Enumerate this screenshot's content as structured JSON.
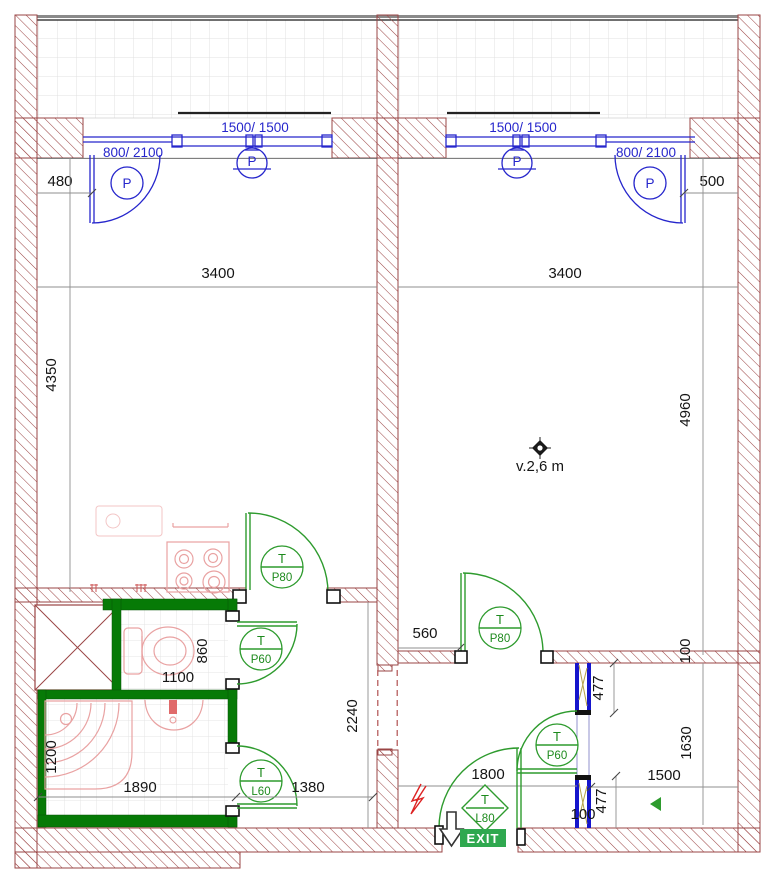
{
  "colors": {
    "wall_hatch": "#9a4444",
    "window_blue": "#2626cc",
    "door_green": "#2e9b2e",
    "bath_wall_green": "#067a06",
    "fixture_pink": "#e9a2a2",
    "exit_bg": "#2fa84f",
    "accent_red": "#dd2222"
  },
  "top": {
    "left_unit": {
      "door_label": "800/ 2100",
      "door_tag": "P",
      "window_label": "1500/ 1500",
      "window_tag": "P",
      "dim_offset": "480",
      "dim_width": "3400",
      "dim_height": "4350"
    },
    "right_unit": {
      "window_label": "1500/ 1500",
      "window_tag": "P",
      "door_label": "800/ 2100",
      "door_tag": "P",
      "dim_offset": "500",
      "dim_width": "3400",
      "dim_height": "4960",
      "ceiling_note": "v.2,6 m"
    }
  },
  "bottom": {
    "bath": {
      "dim_1100": "1100",
      "dim_860": "860",
      "dim_1200": "1200",
      "dim_1890": "1890",
      "dim_1380": "1380",
      "dim_2240": "2240"
    },
    "hall": {
      "dim_560": "560",
      "dim_477_top": "477",
      "dim_100_top": "100",
      "dim_1630": "1630",
      "dim_1500": "1500",
      "dim_1800": "1800",
      "dim_477_bottom": "477",
      "dim_100_bottom": "100"
    },
    "exit_label": "EXIT"
  },
  "door_tags": {
    "kitchen": {
      "letter": "T",
      "code": "P80"
    },
    "bath_upper": {
      "letter": "T",
      "code": "P60"
    },
    "bath_lower": {
      "letter": "T",
      "code": "L60"
    },
    "hall": {
      "letter": "T",
      "code": "P80"
    },
    "wc": {
      "letter": "T",
      "code": "P60"
    },
    "entrance": {
      "letter": "T",
      "code": "L80"
    }
  }
}
